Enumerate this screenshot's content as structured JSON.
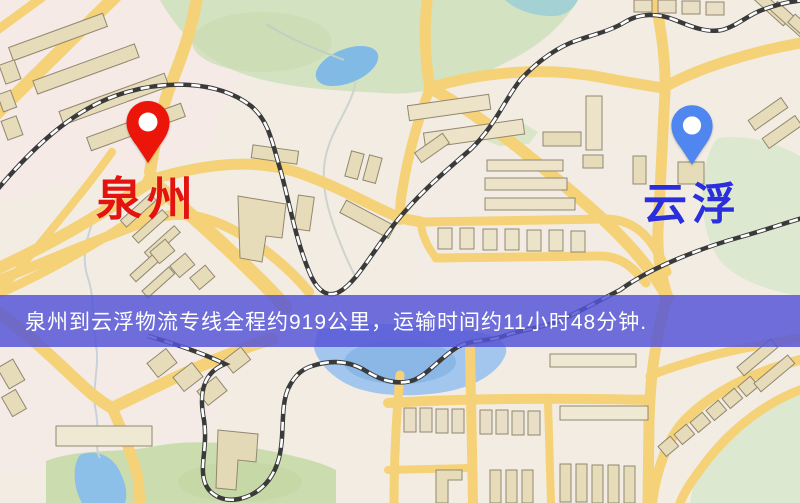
{
  "map": {
    "origin": {
      "name": "泉州",
      "pin_color": "#ec1509",
      "label_color": "#e31410"
    },
    "destination": {
      "name": "云浮",
      "pin_color": "#4f86ef",
      "label_color": "#2a2edd"
    },
    "banner": {
      "text": "泉州到云浮物流专线全程约919公里，运输时间约11小时48分钟.",
      "distance_km": "919",
      "duration": "11小时48分钟",
      "bg_color": "rgba(85,85,214,0.84)",
      "text_color": "#ffffff"
    },
    "colors": {
      "background": "#f2ece3",
      "road": "#f5d278",
      "road_minor": "#f8dd92",
      "park": "#d3e2c0",
      "field": "#cbddae",
      "water": "#86b7e6",
      "building": "#e6dcba",
      "railway": "#3a3a3a"
    }
  }
}
